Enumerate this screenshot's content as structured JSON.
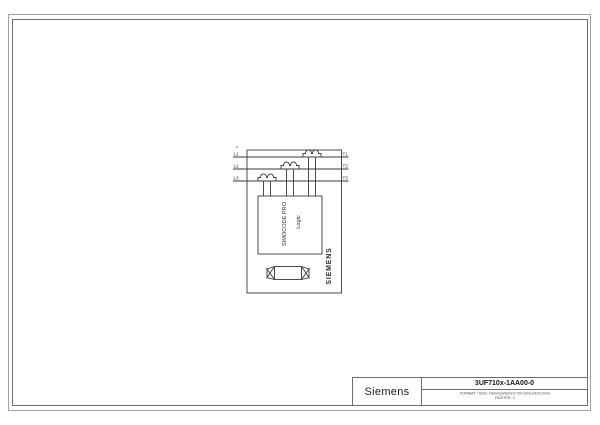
{
  "page": {
    "background": "#ffffff",
    "frame_color": "#a3a3a3",
    "inner_frame_color": "#6e6e6e",
    "drawing_line_color": "#3a3a3a"
  },
  "diagram": {
    "device_name": "SIMOCODE PRO",
    "logic_label": "Logic",
    "brand_vertical": "SIEMENS",
    "footnote_mark": "*",
    "terminals": {
      "left": [
        "L1",
        "L2",
        "L3"
      ],
      "right": [
        "T1",
        "T2",
        "T3"
      ]
    }
  },
  "titleblock": {
    "brand": "Siemens",
    "part_number": "3UF710x-1AA00-0",
    "meta_line1": "FORMAT / SIZE: H(mm)xW(mm)=297.0mmx420.0mm",
    "meta_line2": "RASTER: 4"
  }
}
